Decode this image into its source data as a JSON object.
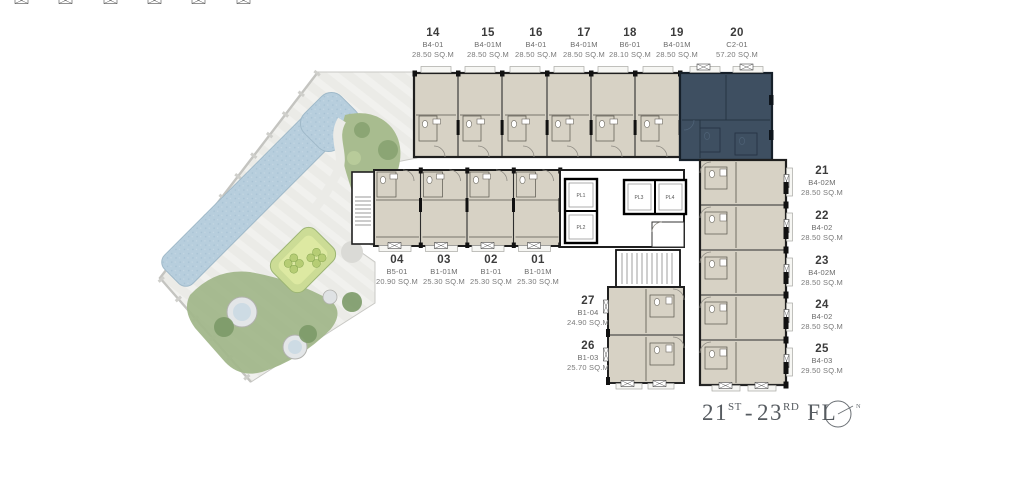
{
  "units": {
    "top": [
      {
        "no": "14",
        "type": "B4-01",
        "area": "28.50 SQ.M"
      },
      {
        "no": "15",
        "type": "B4-01M",
        "area": "28.50 SQ.M"
      },
      {
        "no": "16",
        "type": "B4-01",
        "area": "28.50 SQ.M"
      },
      {
        "no": "17",
        "type": "B4-01M",
        "area": "28.50 SQ.M"
      },
      {
        "no": "18",
        "type": "B6-01",
        "area": "28.10 SQ.M"
      },
      {
        "no": "19",
        "type": "B4-01M",
        "area": "28.50 SQ.M"
      },
      {
        "no": "20",
        "type": "C2-01",
        "area": "57.20 SQ.M"
      }
    ],
    "right": [
      {
        "no": "21",
        "type": "B4-02M",
        "area": "28.50 SQ.M"
      },
      {
        "no": "22",
        "type": "B4-02",
        "area": "28.50 SQ.M"
      },
      {
        "no": "23",
        "type": "B4-02M",
        "area": "28.50 SQ.M"
      },
      {
        "no": "24",
        "type": "B4-02",
        "area": "28.50 SQ.M"
      },
      {
        "no": "25",
        "type": "B4-03",
        "area": "29.50 SQ.M"
      }
    ],
    "bottom": [
      {
        "no": "04",
        "type": "B5-01",
        "area": "20.90 SQ.M"
      },
      {
        "no": "03",
        "type": "B1-01M",
        "area": "25.30 SQ.M"
      },
      {
        "no": "02",
        "type": "B1-01",
        "area": "25.30 SQ.M"
      },
      {
        "no": "01",
        "type": "B1-01M",
        "area": "25.30 SQ.M"
      }
    ],
    "inner": [
      {
        "no": "27",
        "type": "B1-04",
        "area": "24.90 SQ.M"
      },
      {
        "no": "26",
        "type": "B1-03",
        "area": "25.70 SQ.M"
      }
    ]
  },
  "core": {
    "elevators": [
      "PL1",
      "PL2",
      "PL3",
      "PL4"
    ]
  },
  "floor": {
    "num1": "21",
    "sup1": "ST",
    "sep": "-",
    "num2": "23",
    "sup2": "RD",
    "suffix": "FL"
  },
  "compass": {
    "north": "N"
  },
  "highlight": {
    "unit": "20",
    "color": "#3e4f61"
  },
  "colors": {
    "unit_fill": "#d7d2c5",
    "highlight_fill": "#3e4f61",
    "wall": "#1f1f1f",
    "deck": "#ebebe7",
    "pool": "#b7cedd",
    "lawn": "#a2b78b",
    "lounge": "#dde9a2",
    "label_number": "#3c3c3c",
    "label_secondary": "#6b6b6b",
    "floor_text": "#565b60"
  }
}
